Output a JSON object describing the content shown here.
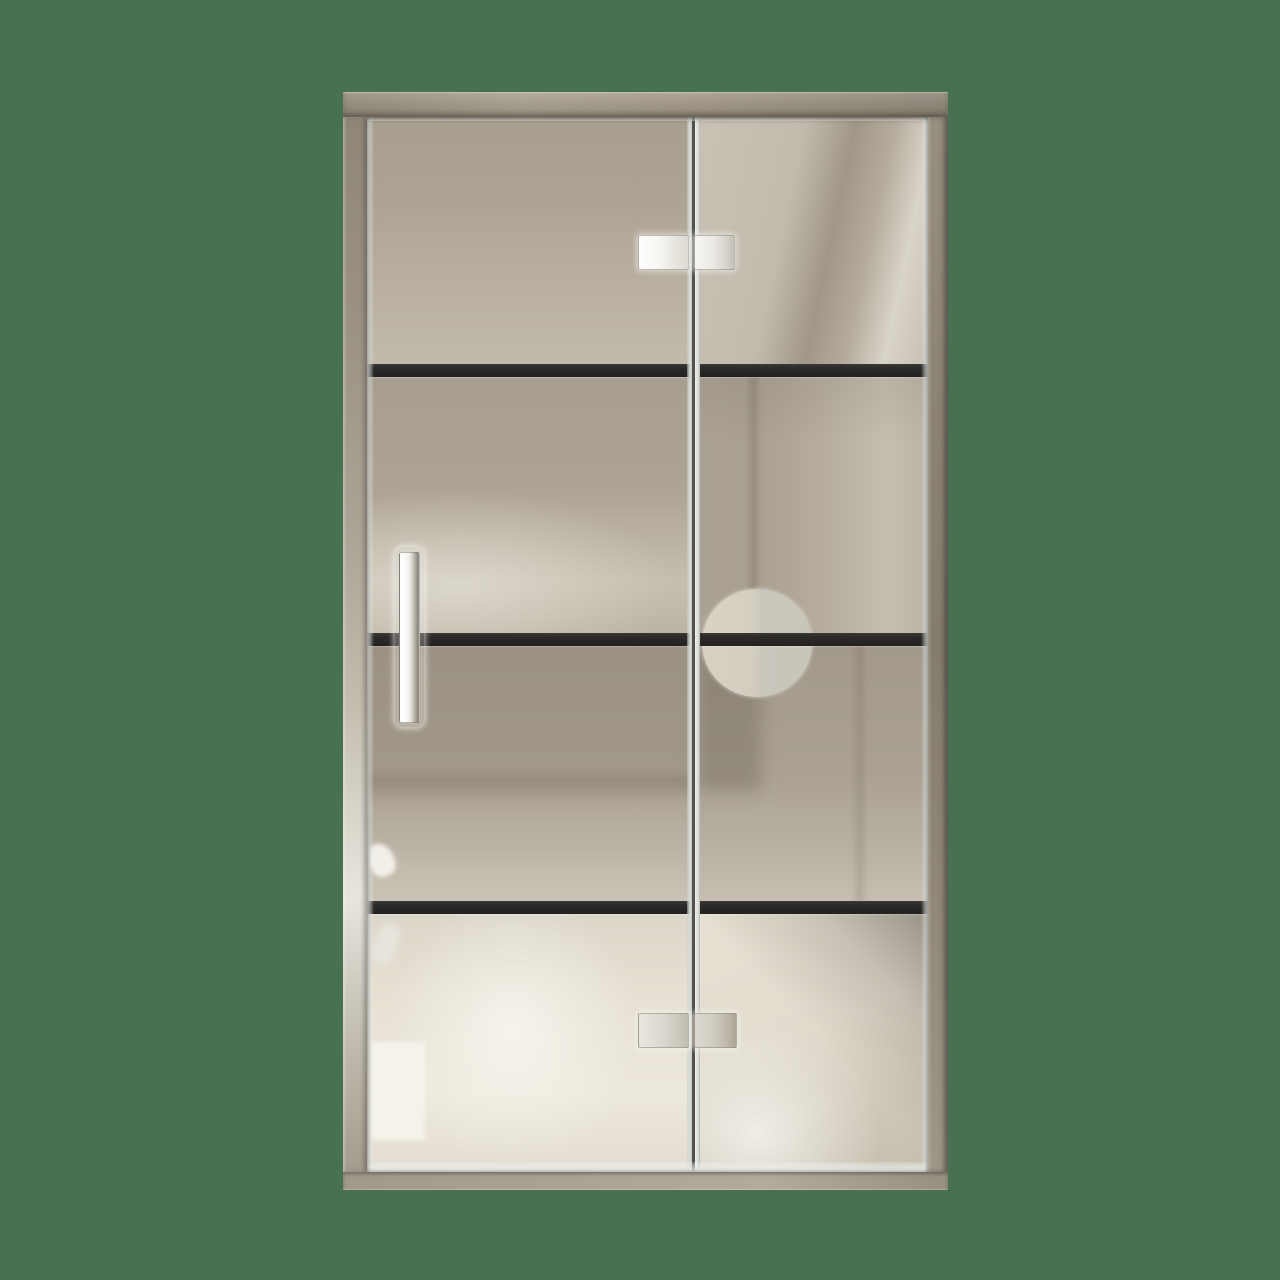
{
  "scene": {
    "type": "3d-product-render",
    "subject": "framed glass pivot shower door with two hinged panels, black grid bars, chrome hardware and frosted circle decal"
  },
  "door": {
    "panel_count": 2,
    "horizontal_bar_count": 3,
    "rows_per_panel": 4,
    "hardware": {
      "top_hinge": "chrome-clamp-hinge",
      "bottom_hinge": "chrome-clamp-hinge",
      "handle": "vertical-bar-handle",
      "decal": "frosted-circle"
    }
  },
  "colors": {
    "background": "#477150",
    "frame_light": "#e8e5de",
    "frame_mid": "#b0a799",
    "frame_dark": "#857c6e",
    "grid_bar": "#2c2b29",
    "glass_taupe": "#b0a798",
    "glass_taupe_dark": "#a09788",
    "glass_cream": "#ede8dc",
    "glass_bright": "#f6f4ed",
    "chrome_light": "#fefefe",
    "chrome_dark": "#c4c0b7",
    "circle_light": "#dad4c6",
    "circle_dark": "#c9c7bc",
    "edge_highlight": "#d8dcd9"
  }
}
